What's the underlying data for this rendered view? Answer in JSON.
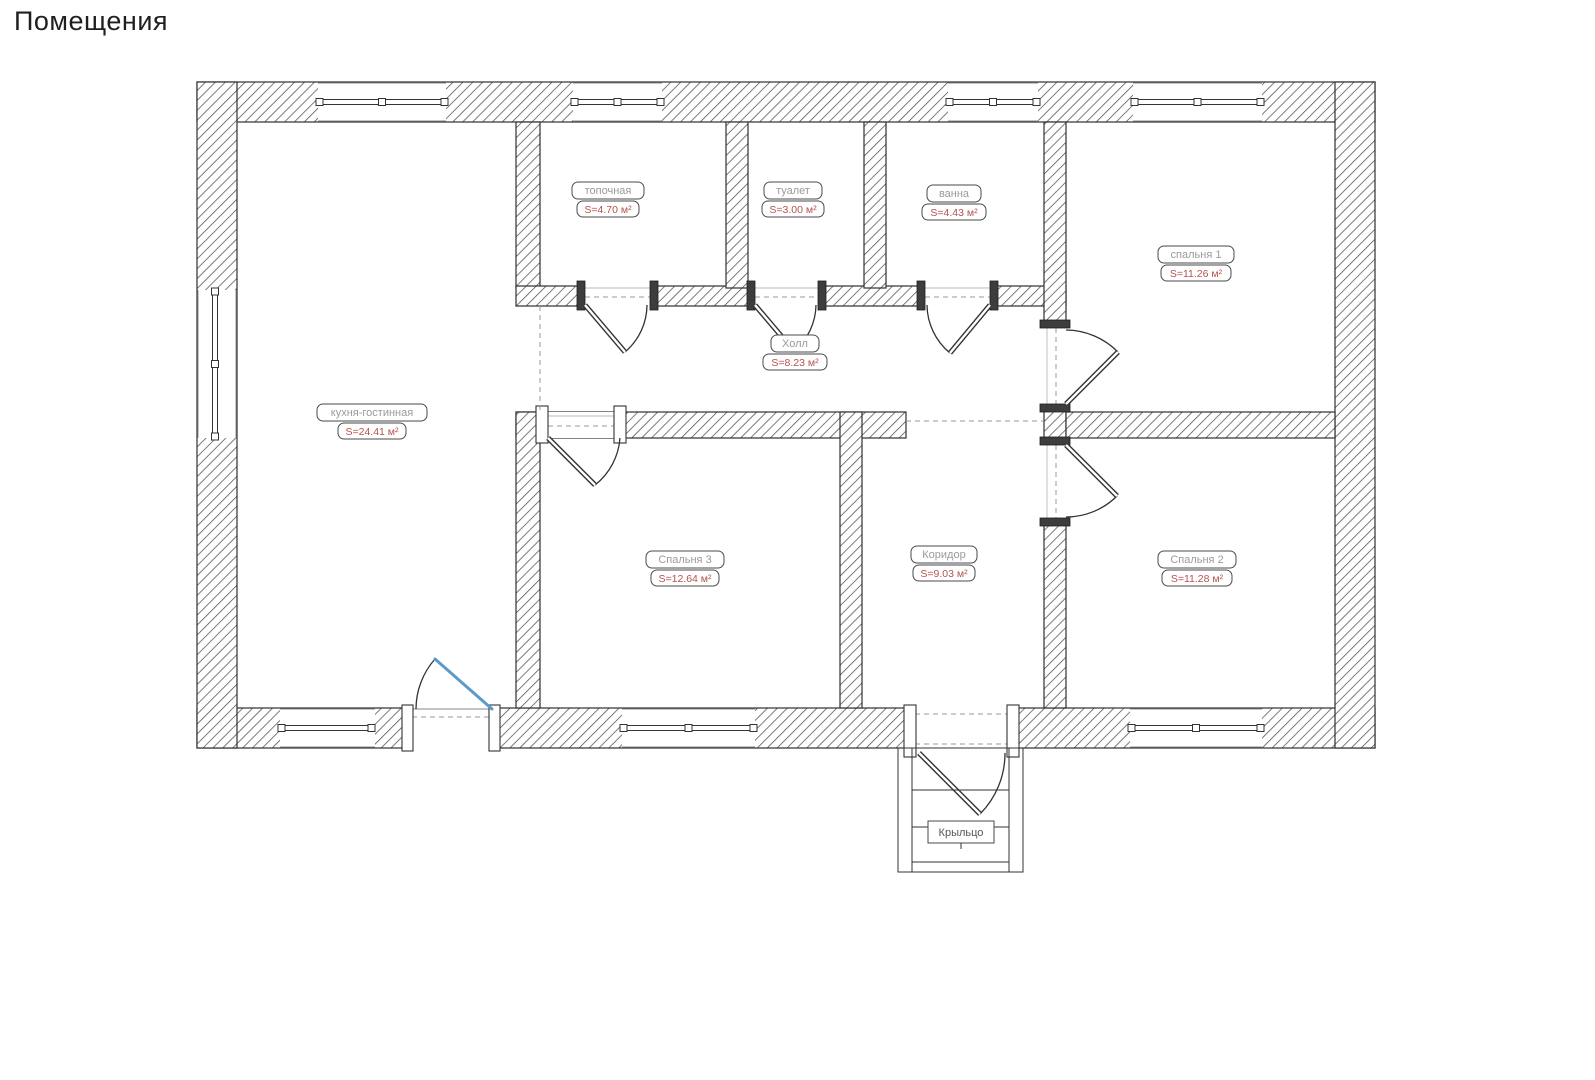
{
  "page": {
    "title": "Помещения"
  },
  "colors": {
    "wall_outline": "#2f2f2f",
    "wall_hatch": "#4f4f4f",
    "room_name_text": "#9a9a9a",
    "room_area_text": "#b4524e",
    "entrance_door": "#5b9bc8",
    "dashed_line": "#9a9a9a",
    "background": "#ffffff"
  },
  "rooms": [
    {
      "name": "топочная",
      "area": "S=4.70 м²"
    },
    {
      "name": "туалет",
      "area": "S=3.00 м²"
    },
    {
      "name": "ванна",
      "area": "S=4.43 м²"
    },
    {
      "name": "спальня 1",
      "area": "S=11.26 м²"
    },
    {
      "name": "Холл",
      "area": "S=8.23 м²"
    },
    {
      "name": "кухня-гостинная",
      "area": "S=24.41 м²"
    },
    {
      "name": "Спальня 3",
      "area": "S=12.64 м²"
    },
    {
      "name": "Коридор",
      "area": "S=9.03 м²"
    },
    {
      "name": "Спальня 2",
      "area": "S=11.28 м²"
    },
    {
      "name": "Крыльцо"
    }
  ]
}
